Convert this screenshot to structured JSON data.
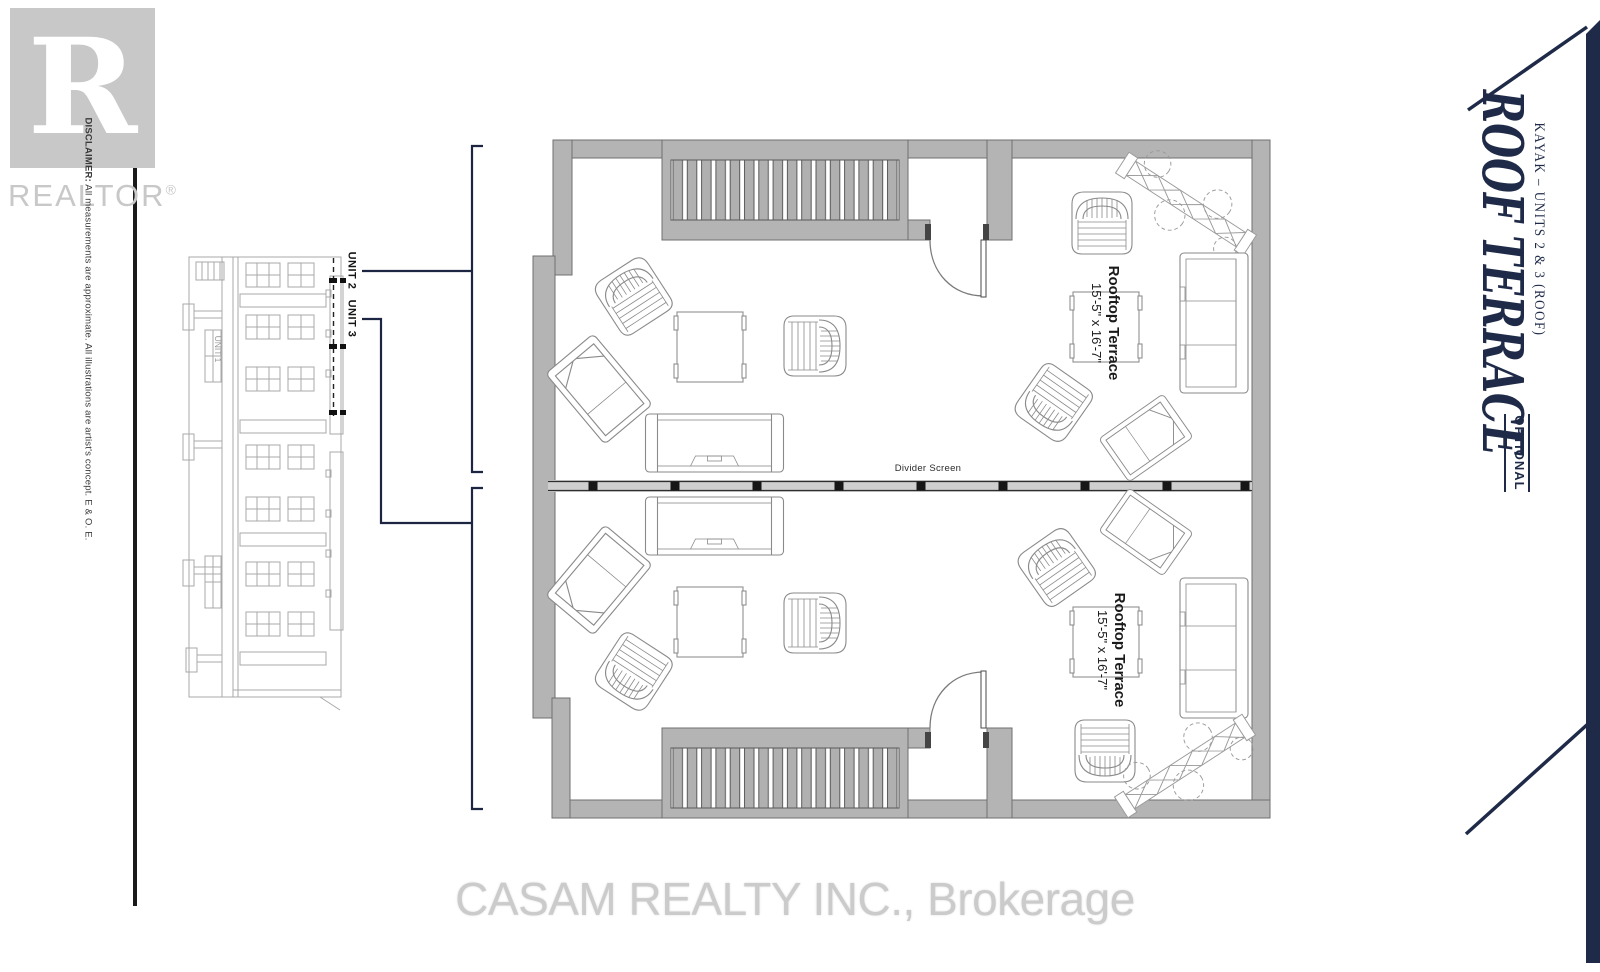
{
  "branding": {
    "realtor": {
      "letter": "R",
      "wordmark": "REALTOR",
      "trademark": "®"
    },
    "watermark": "CASAM REALTY INC., Brokerage"
  },
  "disclaimer": {
    "label": "DISCLAIMER:",
    "text": " All measurements are approximate. All illustrations are artist's concept. E & O. E."
  },
  "title_block": {
    "project": "KAYAK – UNITS 2 & 3 (ROOF)",
    "title": "ROOF TERRACE",
    "tag": "OPTIONAL"
  },
  "key_plan": {
    "unit_2": "UNIT 2",
    "unit_3": "UNIT 3",
    "unit_1": "UNIT 1"
  },
  "floor_plan": {
    "divider_label": "Divider Screen",
    "upper_terrace": {
      "name": "Rooftop Terrace",
      "dims": "15'-5\" x 16'-7\""
    },
    "lower_terrace": {
      "name": "Rooftop Terrace",
      "dims": "15'-5\" x 16'-7\""
    }
  },
  "colors": {
    "accent": "#1e2a47",
    "wall": "#b4b4b4",
    "logo_gray": "#c8c8c8",
    "watermark_gray": "#cbcbcb"
  }
}
